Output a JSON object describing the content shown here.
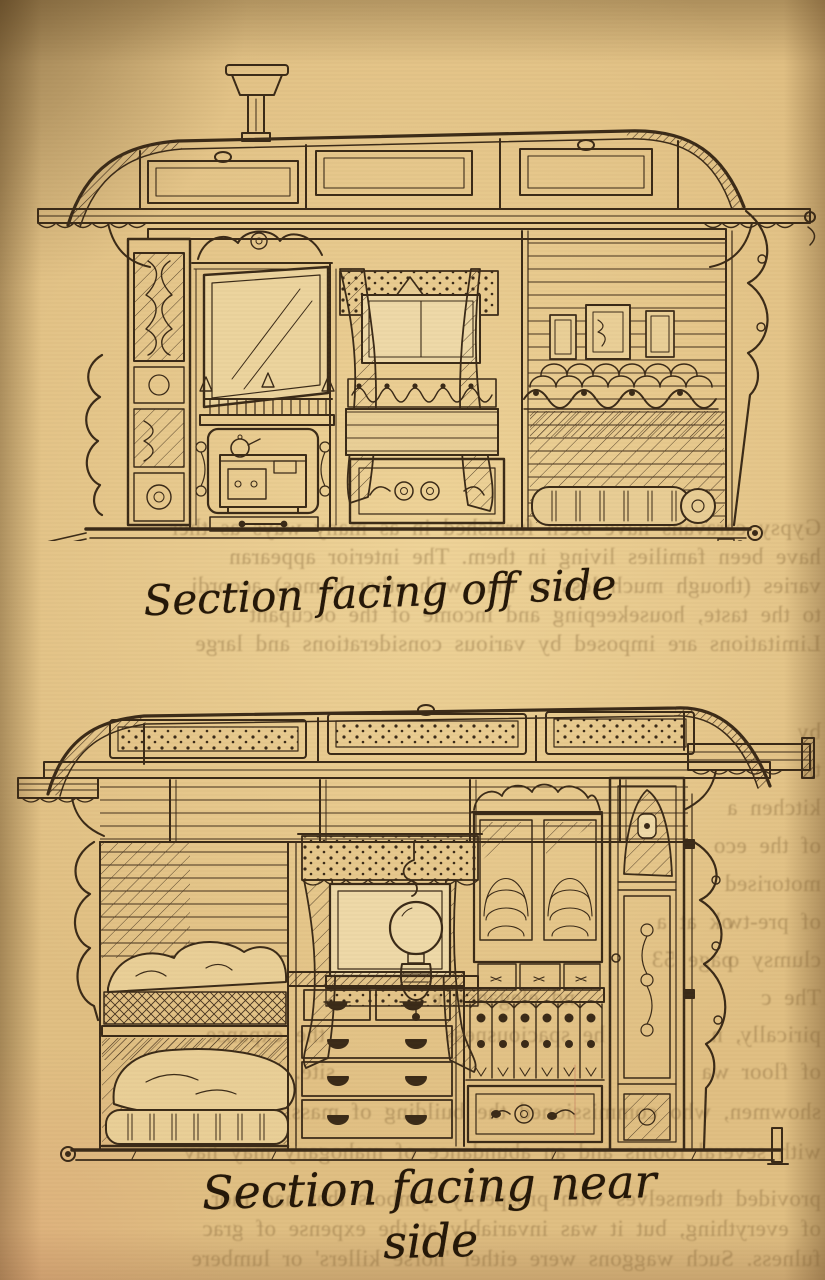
{
  "captions": {
    "top": "Section facing off side",
    "bottom": "Section facing near side"
  },
  "bleed": {
    "lines": [
      {
        "text": "Gypsy caravans have been furnished in as many ways as ther",
        "top": 516
      },
      {
        "text": "have been families living in them. The interior appearan",
        "top": 545
      },
      {
        "text": "varies (though much less so than with other homes) accordi",
        "top": 574
      },
      {
        "text": "to the taste, housekeeping and income of the occupant",
        "top": 603
      },
      {
        "text": "Limitations are imposed by various considerations and large",
        "top": 632
      },
      {
        "text": "by",
        "top": 720
      },
      {
        "text": "th",
        "top": 758
      },
      {
        "text": "kitchen a",
        "top": 796
      },
      {
        "text": "of the eco",
        "top": 834
      },
      {
        "text": "motorised",
        "top": 872
      },
      {
        "text": "of pre-tw",
        "top": 910
      },
      {
        "text": "ok at a",
        "top": 910,
        "indent": 92
      },
      {
        "text": "clumsy o",
        "top": 948
      },
      {
        "text": "page 53",
        "top": 948,
        "indent": 92
      },
      {
        "text": "The c",
        "top": 986
      },
      {
        "text": "nd elegance e",
        "top": 986,
        "indent": 250
      },
      {
        "text": "pirically, n",
        "top": 1023
      },
      {
        "text": "he spaciousness",
        "top": 1023,
        "indent": 220
      },
      {
        "text": "the expanse",
        "top": 1023,
        "indent": 500
      },
      {
        "text": "of floor wa",
        "top": 1060
      },
      {
        "text": "site. Ric",
        "top": 1060,
        "indent": 490
      },
      {
        "text": "showmen, who commissioned the building of massive va",
        "top": 1100
      },
      {
        "text": "with several rooms and an abundance of mahogany may hav",
        "top": 1140
      },
      {
        "text": "provided themselves with prosperity symbols that had mor",
        "top": 1187
      },
      {
        "text": "of everything, but it was invariably at the expense of grac",
        "top": 1217
      },
      {
        "text": "fulness. Such waggons were either 'horse killers' or lumbere",
        "top": 1247
      }
    ]
  }
}
